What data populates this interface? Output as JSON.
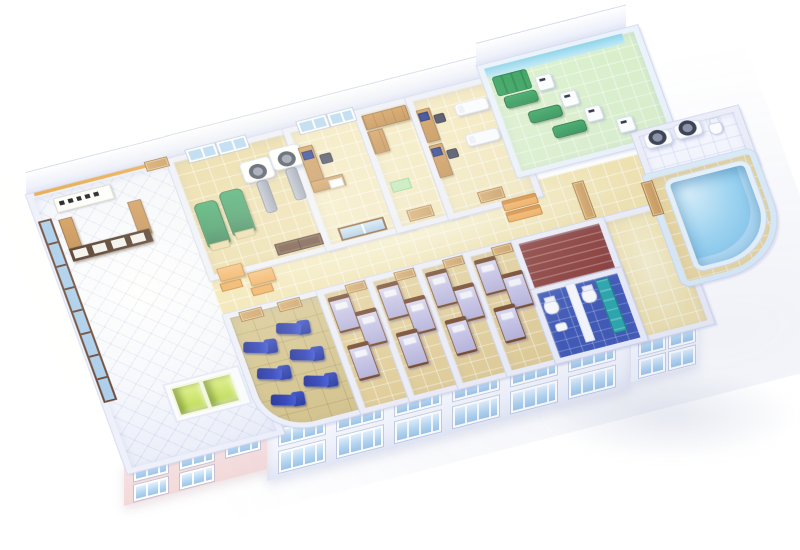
{
  "description": "3D isometric cutaway floor plan of a hospital clinic floor",
  "palette": {
    "background": "#ffffff",
    "wall_top": "#eef0fa",
    "wall_edge": "#d3d9f0",
    "floor_tan": "#ead9a2",
    "floor_ward": "#e4cf96",
    "floor_corridor": "#f1e3ad",
    "floor_khaki": "#d5c48c",
    "floor_green": "#d9efcc",
    "floor_stairs": "#8a3a34",
    "floor_bath": "#3d57b6",
    "bed_linen": "#c6c3e8",
    "bed_frame": "#7a4a2c",
    "recliner_blue": "#2b3db8",
    "recliner_blue_dark": "#1f2f98",
    "exam_green": "#2e9156",
    "pool_water_light": "#9fd8f3",
    "pool_water_deep": "#6fb9e8",
    "elevator_green": "#b9d94b",
    "facade_pink": "#f6e2e2",
    "window_glass": "#b5d7f2",
    "wood": "#c08a4a",
    "wood_dark": "#9a6a34",
    "desk_brown": "#4a2f1e",
    "door_tan": "#c99a5c",
    "door_brown": "#5a3420",
    "bench_orange": "#efa851",
    "teal": "#28a8ac",
    "cyan_wall": "#8ed4ea",
    "slab_gray": "#8f97ac",
    "monitor_blue": "#1e3690",
    "trim_orange": "#e8a84a"
  },
  "scene": {
    "rooms": [
      {
        "n": "lobby",
        "floor": "lobby",
        "x": 0,
        "y": 0,
        "w": 152,
        "h": 336
      },
      {
        "n": "corridor",
        "floor": "corridor",
        "x": 146,
        "y": 132,
        "w": 456,
        "h": 70,
        "cls": "no-wall"
      },
      {
        "n": "hall-right",
        "floor": "corridor",
        "x": 530,
        "y": 194,
        "w": 72,
        "h": 142
      },
      {
        "n": "imaging-room",
        "floor": "tan",
        "x": 146,
        "y": 0,
        "w": 128,
        "h": 140
      },
      {
        "n": "office-1",
        "floor": "cream",
        "x": 268,
        "y": 0,
        "w": 80,
        "h": 140
      },
      {
        "n": "storage-room",
        "floor": "cream",
        "x": 342,
        "y": 0,
        "w": 60,
        "h": 140
      },
      {
        "n": "exam-office",
        "floor": "cream",
        "x": 396,
        "y": 0,
        "w": 86,
        "h": 140
      },
      {
        "n": "pt-room",
        "floor": "green",
        "x": 476,
        "y": -15,
        "w": 156,
        "h": 127,
        "cls": "pt-walls"
      },
      {
        "n": "scan-room-2",
        "floor": "white",
        "x": 600,
        "y": 106,
        "w": 100,
        "h": 62
      },
      {
        "n": "pool-room",
        "floor": "deck",
        "x": 596,
        "y": 158,
        "w": 104,
        "h": 128,
        "radius": "4px 10px 70px 10px",
        "cls": "pool-walls"
      },
      {
        "n": "infusion-room",
        "floor": "khaki",
        "x": 146,
        "y": 194,
        "w": 100,
        "h": 142,
        "radius": "2px 2px 16px 52px"
      },
      {
        "n": "ward-1",
        "floor": "ward",
        "x": 244,
        "y": 194,
        "w": 53,
        "h": 142
      },
      {
        "n": "ward-2",
        "floor": "ward",
        "x": 295,
        "y": 194,
        "w": 53,
        "h": 142
      },
      {
        "n": "ward-3",
        "floor": "ward",
        "x": 346,
        "y": 194,
        "w": 53,
        "h": 142
      },
      {
        "n": "ward-4",
        "floor": "ward",
        "x": 397,
        "y": 194,
        "w": 53,
        "h": 142
      },
      {
        "n": "stair-room",
        "floor": "stairs",
        "x": 448,
        "y": 194,
        "w": 84,
        "h": 70
      },
      {
        "n": "bathroom",
        "floor": "bath",
        "x": 448,
        "y": 256,
        "w": 84,
        "h": 80
      }
    ],
    "furniture": [
      {
        "t": "winwall",
        "n": "glass-window-wall",
        "x": 2,
        "y": 34,
        "w": 10,
        "h": 226
      },
      {
        "t": "trim",
        "n": "wall-trim-orange",
        "x": 8,
        "y": 0,
        "w": 136,
        "h": 4
      },
      {
        "t": "sign",
        "n": "reception-sign",
        "x": 24,
        "y": 12,
        "w": 58,
        "h": 16
      },
      {
        "t": "wood",
        "n": "reception-desk-left-wing",
        "x": 22,
        "y": 38,
        "w": 12,
        "h": 40
      },
      {
        "t": "wood",
        "n": "reception-desk-right-wing",
        "x": 94,
        "y": 38,
        "w": 12,
        "h": 40
      },
      {
        "t": "deskpanel",
        "n": "reception-desk-front",
        "x": 22,
        "y": 74,
        "w": 84,
        "h": 16
      },
      {
        "t": "door",
        "n": "lobby-back-door",
        "x": 124,
        "y": -3,
        "w": 22,
        "h": 10
      },
      {
        "t": "liftbase",
        "n": "elevator-bank",
        "x": 64,
        "y": 256,
        "w": 76,
        "h": 44
      },
      {
        "t": "lift",
        "n": "elevator-door",
        "x": 70,
        "y": 262,
        "w": 28,
        "h": 32
      },
      {
        "t": "lift",
        "n": "elevator-door",
        "x": 102,
        "y": 262,
        "w": 28,
        "h": 32
      },
      {
        "t": "table-orange",
        "n": "waiting-table",
        "x": 156,
        "y": 140,
        "w": 24,
        "h": 14
      },
      {
        "t": "chair-orange",
        "n": "waiting-bench",
        "x": 154,
        "y": 158,
        "w": 20,
        "h": 8
      },
      {
        "t": "table-orange",
        "n": "waiting-table",
        "x": 184,
        "y": 154,
        "w": 24,
        "h": 14
      },
      {
        "t": "chair-orange",
        "n": "waiting-bench",
        "x": 182,
        "y": 172,
        "w": 20,
        "h": 8
      },
      {
        "t": "window",
        "n": "window",
        "x": 168,
        "y": -4,
        "w": 26,
        "h": 11
      },
      {
        "t": "window",
        "n": "window",
        "x": 200,
        "y": -4,
        "w": 26,
        "h": 11
      },
      {
        "t": "gbed",
        "n": "exam-table-green",
        "x": 156,
        "y": 60,
        "w": 22,
        "h": 52
      },
      {
        "t": "gbed",
        "n": "exam-table-green",
        "x": 184,
        "y": 54,
        "w": 22,
        "h": 52
      },
      {
        "t": "scanner",
        "n": "ct-scanner",
        "x": 214,
        "y": 26,
        "w": 30,
        "h": 24
      },
      {
        "t": "slab",
        "n": "scanner-table",
        "x": 224,
        "y": 52,
        "w": 10,
        "h": 38
      },
      {
        "t": "scanner",
        "n": "ct-scanner",
        "x": 246,
        "y": 20,
        "w": 30,
        "h": 24
      },
      {
        "t": "slab",
        "n": "scanner-table",
        "x": 256,
        "y": 46,
        "w": 10,
        "h": 38
      },
      {
        "t": "ddoor",
        "n": "double-door-brown",
        "x": 220,
        "y": 129,
        "w": 46,
        "h": 12
      },
      {
        "t": "window",
        "n": "window",
        "x": 284,
        "y": -4,
        "w": 26,
        "h": 11
      },
      {
        "t": "window",
        "n": "window",
        "x": 316,
        "y": -4,
        "w": 22,
        "h": 11
      },
      {
        "t": "desk",
        "n": "office-desk",
        "x": 276,
        "y": 26,
        "w": 13,
        "h": 46
      },
      {
        "t": "desk",
        "n": "office-desk-return",
        "x": 276,
        "y": 68,
        "w": 32,
        "h": 12
      },
      {
        "t": "monitor",
        "n": "computer-monitor",
        "x": 278,
        "y": 32,
        "w": 9,
        "h": 8
      },
      {
        "t": "chair",
        "n": "office-chair",
        "x": 294,
        "y": 40,
        "w": 10,
        "h": 10
      },
      {
        "t": "paper",
        "n": "paper-sheet",
        "x": 294,
        "y": 72,
        "w": 12,
        "h": 8
      },
      {
        "t": "gdoor",
        "n": "sliding-glass-door",
        "x": 286,
        "y": 129,
        "w": 44,
        "h": 12
      },
      {
        "t": "cabinet",
        "n": "storage-cabinet",
        "x": 348,
        "y": 8,
        "w": 44,
        "h": 16
      },
      {
        "t": "cabinet",
        "n": "storage-cabinet",
        "x": 348,
        "y": 28,
        "w": 14,
        "h": 26
      },
      {
        "t": "mat",
        "n": "green-mat",
        "x": 352,
        "y": 92,
        "w": 18,
        "h": 11
      },
      {
        "t": "door",
        "n": "room-door",
        "x": 358,
        "y": 129,
        "w": 24,
        "h": 12
      },
      {
        "t": "desk",
        "n": "exam-desk",
        "x": 402,
        "y": 18,
        "w": 12,
        "h": 38
      },
      {
        "t": "monitor",
        "n": "computer-monitor",
        "x": 403,
        "y": 22,
        "w": 8,
        "h": 8
      },
      {
        "t": "chair",
        "n": "office-chair",
        "x": 417,
        "y": 28,
        "w": 9,
        "h": 9
      },
      {
        "t": "desk",
        "n": "exam-desk",
        "x": 402,
        "y": 62,
        "w": 12,
        "h": 38
      },
      {
        "t": "monitor",
        "n": "computer-monitor",
        "x": 403,
        "y": 66,
        "w": 8,
        "h": 8
      },
      {
        "t": "chair",
        "n": "office-chair",
        "x": 417,
        "y": 72,
        "w": 9,
        "h": 9
      },
      {
        "t": "couch",
        "n": "exam-couch",
        "x": 440,
        "y": 22,
        "w": 32,
        "h": 13
      },
      {
        "t": "couch",
        "n": "exam-couch",
        "x": 440,
        "y": 60,
        "w": 32,
        "h": 13
      },
      {
        "t": "door",
        "n": "room-door",
        "x": 432,
        "y": 129,
        "w": 24,
        "h": 12
      },
      {
        "t": "cyanband",
        "n": "cyan-wall-band",
        "x": 482,
        "y": -10,
        "w": 144,
        "h": 12
      },
      {
        "t": "wallmat",
        "n": "therapy-wall-mat",
        "x": 486,
        "y": 2,
        "w": 34,
        "h": 22
      },
      {
        "t": "gtable",
        "n": "therapy-table",
        "x": 490,
        "y": 28,
        "w": 32,
        "h": 13
      },
      {
        "t": "machine",
        "n": "therapy-machine",
        "x": 527,
        "y": 14,
        "w": 15,
        "h": 16
      },
      {
        "t": "gtable",
        "n": "therapy-table",
        "x": 508,
        "y": 52,
        "w": 32,
        "h": 13
      },
      {
        "t": "machine",
        "n": "therapy-machine",
        "x": 545,
        "y": 40,
        "w": 15,
        "h": 16
      },
      {
        "t": "gtable",
        "n": "therapy-table",
        "x": 526,
        "y": 76,
        "w": 32,
        "h": 13
      },
      {
        "t": "machine",
        "n": "therapy-machine",
        "x": 563,
        "y": 64,
        "w": 15,
        "h": 16
      },
      {
        "t": "machine",
        "n": "therapy-machine",
        "x": 590,
        "y": 86,
        "w": 15,
        "h": 16
      },
      {
        "t": "scanner",
        "n": "ct-scanner",
        "x": 610,
        "y": 112,
        "w": 26,
        "h": 16
      },
      {
        "t": "scanner",
        "n": "ct-scanner",
        "x": 642,
        "y": 110,
        "w": 26,
        "h": 16
      },
      {
        "t": "toilet",
        "n": "toilet",
        "x": 676,
        "y": 116,
        "w": 12,
        "h": 15
      },
      {
        "t": "pool",
        "n": "hydrotherapy-pool",
        "x": 614,
        "y": 170,
        "w": 78,
        "h": 104
      },
      {
        "t": "door",
        "n": "hall-door",
        "x": 526,
        "y": 146,
        "w": 10,
        "h": 44
      },
      {
        "t": "door",
        "n": "pool-door",
        "x": 592,
        "y": 166,
        "w": 10,
        "h": 40
      },
      {
        "t": "bench",
        "n": "corridor-bench",
        "x": 452,
        "y": 146,
        "w": 34,
        "h": 11
      },
      {
        "t": "bench",
        "n": "corridor-bench",
        "x": 452,
        "y": 160,
        "w": 34,
        "h": 11
      },
      {
        "t": "partition",
        "n": "bath-partition",
        "x": 484,
        "y": 260,
        "w": 8,
        "h": 70
      },
      {
        "t": "toilet",
        "n": "toilet",
        "x": 456,
        "y": 272,
        "w": 13,
        "h": 16
      },
      {
        "t": "toilet",
        "n": "toilet",
        "x": 496,
        "y": 270,
        "w": 13,
        "h": 16
      },
      {
        "t": "sink",
        "n": "sink",
        "x": 460,
        "y": 302,
        "w": 10,
        "h": 8
      },
      {
        "t": "tealcab",
        "n": "teal-cabinet",
        "x": 514,
        "y": 264,
        "w": 12,
        "h": 64
      },
      {
        "t": "door",
        "n": "ward-door",
        "x": 162,
        "y": 196,
        "w": 22,
        "h": 10
      },
      {
        "t": "door",
        "n": "ward-door",
        "x": 202,
        "y": 196,
        "w": 22,
        "h": 10
      },
      {
        "t": "recliner",
        "n": "iv-recliner-chair",
        "x": 154,
        "y": 232,
        "w": 34,
        "h": 20,
        "rot": 18
      },
      {
        "t": "recliner",
        "n": "iv-recliner-chair",
        "x": 192,
        "y": 220,
        "w": 34,
        "h": 20,
        "rot": 18
      },
      {
        "t": "recliner",
        "n": "iv-recliner-chair",
        "x": 158,
        "y": 266,
        "w": 34,
        "h": 20,
        "rot": 18
      },
      {
        "t": "recliner",
        "n": "iv-recliner-chair",
        "x": 196,
        "y": 254,
        "w": 34,
        "h": 20,
        "rot": 18
      },
      {
        "t": "recliner",
        "n": "iv-recliner-chair",
        "x": 162,
        "y": 300,
        "w": 34,
        "h": 20,
        "rot": 18
      },
      {
        "t": "recliner",
        "n": "iv-recliner-chair",
        "x": 200,
        "y": 288,
        "w": 34,
        "h": 20,
        "rot": 18
      },
      {
        "t": "bed",
        "n": "hospital-bed",
        "x": 252,
        "y": 206,
        "w": 20,
        "h": 40
      },
      {
        "t": "bed",
        "n": "hospital-bed",
        "x": 273,
        "y": 230,
        "w": 20,
        "h": 40
      },
      {
        "t": "bed",
        "n": "hospital-bed",
        "x": 254,
        "y": 266,
        "w": 20,
        "h": 40
      },
      {
        "t": "door",
        "n": "ward-door",
        "x": 273,
        "y": 196,
        "w": 19,
        "h": 9
      },
      {
        "t": "bed",
        "n": "hospital-bed",
        "x": 303,
        "y": 206,
        "w": 20,
        "h": 40
      },
      {
        "t": "bed",
        "n": "hospital-bed",
        "x": 324,
        "y": 230,
        "w": 20,
        "h": 40
      },
      {
        "t": "bed",
        "n": "hospital-bed",
        "x": 305,
        "y": 266,
        "w": 20,
        "h": 40
      },
      {
        "t": "door",
        "n": "ward-door",
        "x": 324,
        "y": 196,
        "w": 19,
        "h": 9
      },
      {
        "t": "bed",
        "n": "hospital-bed",
        "x": 354,
        "y": 206,
        "w": 20,
        "h": 40
      },
      {
        "t": "bed",
        "n": "hospital-bed",
        "x": 375,
        "y": 230,
        "w": 20,
        "h": 40
      },
      {
        "t": "bed",
        "n": "hospital-bed",
        "x": 356,
        "y": 266,
        "w": 20,
        "h": 40
      },
      {
        "t": "door",
        "n": "ward-door",
        "x": 375,
        "y": 196,
        "w": 19,
        "h": 9
      },
      {
        "t": "bed",
        "n": "hospital-bed",
        "x": 405,
        "y": 206,
        "w": 20,
        "h": 40
      },
      {
        "t": "bed",
        "n": "hospital-bed",
        "x": 426,
        "y": 230,
        "w": 20,
        "h": 40
      },
      {
        "t": "bed",
        "n": "hospital-bed",
        "x": 407,
        "y": 266,
        "w": 20,
        "h": 40
      },
      {
        "t": "door",
        "n": "ward-door",
        "x": 426,
        "y": 196,
        "w": 19,
        "h": 9
      }
    ],
    "facade": {
      "skew": -14.4,
      "strips": [
        {
          "kind": "wall",
          "n": "back-wall-lobby",
          "x": 26,
          "y": 173,
          "w": 143,
          "h": 22
        },
        {
          "kind": "wall",
          "n": "back-wall-center",
          "x": 165,
          "y": 137,
          "w": 316,
          "h": 22
        },
        {
          "kind": "wall",
          "n": "back-wall-pt",
          "x": 476,
          "y": 44,
          "w": 150,
          "h": 22
        },
        {
          "kind": "main",
          "n": "front-facade",
          "x": 267,
          "y": 427,
          "w": 363,
          "h": 54,
          "windows": [
            {
              "x": 12,
              "y": 5,
              "w": 42,
              "h": 13
            },
            {
              "x": 70,
              "y": 5,
              "w": 42,
              "h": 13
            },
            {
              "x": 128,
              "y": 5,
              "w": 42,
              "h": 13
            },
            {
              "x": 186,
              "y": 5,
              "w": 42,
              "h": 13
            },
            {
              "x": 244,
              "y": 5,
              "w": 42,
              "h": 13
            },
            {
              "x": 302,
              "y": 5,
              "w": 42,
              "h": 13
            },
            {
              "x": 12,
              "y": 28,
              "w": 42,
              "h": 17
            },
            {
              "x": 70,
              "y": 28,
              "w": 42,
              "h": 17
            },
            {
              "x": 128,
              "y": 28,
              "w": 42,
              "h": 17
            },
            {
              "x": 186,
              "y": 28,
              "w": 42,
              "h": 17
            },
            {
              "x": 244,
              "y": 28,
              "w": 42,
              "h": 17
            },
            {
              "x": 302,
              "y": 28,
              "w": 42,
              "h": 17
            }
          ]
        },
        {
          "kind": "pink",
          "n": "front-facade-left",
          "x": 124,
          "y": 464,
          "w": 143,
          "h": 42,
          "windows": [
            {
              "x": 10,
              "y": 4,
              "w": 30,
              "h": 12
            },
            {
              "x": 56,
              "y": 4,
              "w": 30,
              "h": 12
            },
            {
              "x": 102,
              "y": 4,
              "w": 30,
              "h": 12
            },
            {
              "x": 10,
              "y": 24,
              "w": 30,
              "h": 12
            },
            {
              "x": 56,
              "y": 24,
              "w": 30,
              "h": 12
            }
          ]
        },
        {
          "kind": "right",
          "n": "side-facade-right",
          "x": 631,
          "y": 334,
          "w": 67,
          "h": 48,
          "windows": [
            {
              "x": 8,
              "y": 6,
              "w": 22,
              "h": 14
            },
            {
              "x": 38,
              "y": 6,
              "w": 22,
              "h": 14
            },
            {
              "x": 8,
              "y": 28,
              "w": 22,
              "h": 14
            },
            {
              "x": 38,
              "y": 28,
              "w": 22,
              "h": 14
            }
          ]
        }
      ]
    }
  }
}
